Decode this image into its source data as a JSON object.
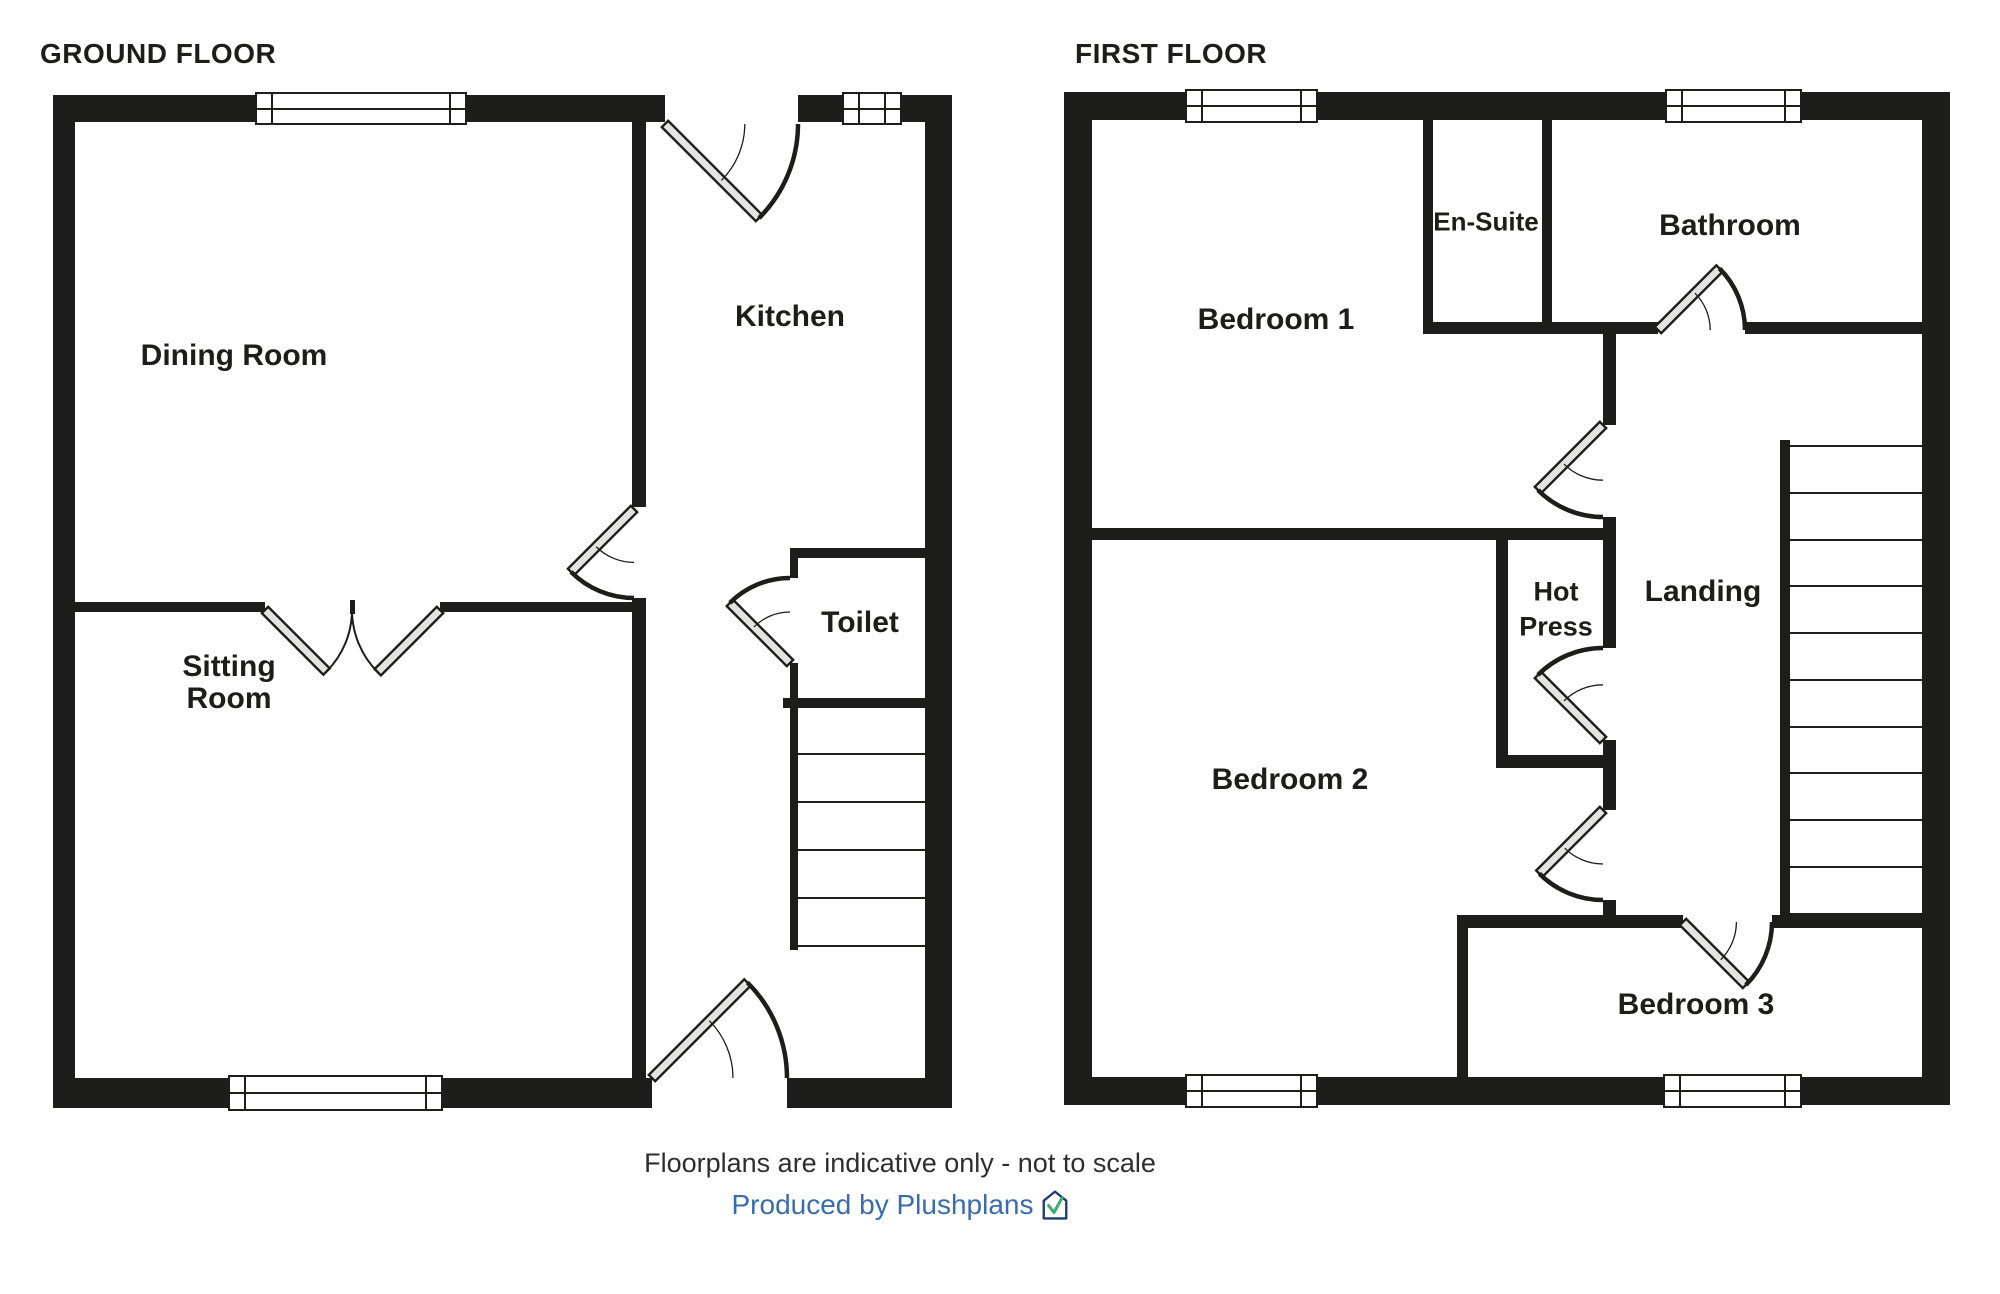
{
  "colors": {
    "wall": "#1d1d1b",
    "line": "#1d1d1b",
    "door_leaf_fill": "#e3e3e3",
    "footer_text": "#2e2e2e",
    "credit_blue": "#3a6cad",
    "logo_navy": "#1f3d73",
    "logo_green": "#3bad68"
  },
  "floors": [
    {
      "id": "ground-floor",
      "title": "GROUND FLOOR",
      "walls": [
        [
          53,
          95,
          612,
          27
        ],
        [
          798,
          95,
          154,
          27
        ],
        [
          53,
          95,
          22,
          1013
        ],
        [
          925,
          95,
          27,
          1013
        ],
        [
          53,
          1078,
          599,
          30
        ],
        [
          787,
          1078,
          165,
          30
        ],
        [
          632,
          122,
          14,
          385
        ],
        [
          632,
          598,
          14,
          480
        ],
        [
          75,
          602,
          190,
          10
        ],
        [
          440,
          602,
          192,
          10
        ],
        [
          350,
          600,
          5,
          14
        ],
        [
          790,
          548,
          135,
          10
        ],
        [
          790,
          558,
          8,
          20
        ],
        [
          790,
          663,
          8,
          45
        ],
        [
          783,
          698,
          142,
          10
        ],
        [
          790,
          708,
          8,
          242
        ]
      ],
      "windows": [
        [
          255,
          92,
          212,
          33
        ],
        [
          842,
          92,
          60,
          33
        ],
        [
          228,
          1075,
          215,
          36
        ]
      ],
      "stair_treads": {
        "x": 798,
        "w": 127,
        "ys": [
          753,
          801,
          849,
          897,
          945
        ]
      },
      "doors": [
        {
          "hinge": [
            665,
            124
          ],
          "len": 133,
          "leaf": 45,
          "jamb": 0,
          "style": "single"
        },
        {
          "hinge": [
            634,
            509
          ],
          "len": 89,
          "leaf": 135,
          "jamb": 90,
          "style": "single"
        },
        {
          "hinge": [
            265,
            610
          ],
          "len": 87,
          "leaf": 45,
          "jamb": 0,
          "style": "double"
        },
        {
          "hinge": [
            440,
            610
          ],
          "len": 88,
          "leaf": 135,
          "jamb": 180,
          "style": "double"
        },
        {
          "hinge": [
            790,
            663
          ],
          "len": 85,
          "leaf": 225,
          "jamb": 270,
          "style": "single"
        },
        {
          "hinge": [
            652,
            1078
          ],
          "len": 135,
          "leaf": -45,
          "jamb": 0,
          "style": "single"
        }
      ],
      "rooms": [
        {
          "label": "Dining Room",
          "x": 234,
          "y": 356,
          "size": 30
        },
        {
          "label": "Kitchen",
          "x": 790,
          "y": 317,
          "size": 30
        },
        {
          "label": "Toilet",
          "x": 860,
          "y": 623,
          "size": 30
        },
        {
          "label": "Sitting",
          "x": 229,
          "y": 667,
          "size": 30
        },
        {
          "label": "Room",
          "x": 229,
          "y": 699,
          "size": 30
        }
      ]
    },
    {
      "id": "first-floor",
      "title": "FIRST FLOOR",
      "walls": [
        [
          1064,
          92,
          886,
          28
        ],
        [
          1064,
          92,
          28,
          1013
        ],
        [
          1922,
          92,
          28,
          1013
        ],
        [
          1064,
          1077,
          886,
          28
        ],
        [
          1423,
          120,
          10,
          212
        ],
        [
          1542,
          120,
          10,
          204
        ],
        [
          1423,
          322,
          235,
          12
        ],
        [
          1745,
          322,
          177,
          12
        ],
        [
          1603,
          334,
          13,
          91
        ],
        [
          1603,
          517,
          13,
          131
        ],
        [
          1603,
          740,
          13,
          70
        ],
        [
          1603,
          900,
          13,
          28
        ],
        [
          1092,
          528,
          524,
          12
        ],
        [
          1496,
          540,
          12,
          228
        ],
        [
          1496,
          755,
          120,
          13
        ],
        [
          1457,
          915,
          226,
          13
        ],
        [
          1772,
          915,
          18,
          13
        ],
        [
          1775,
          915,
          147,
          13
        ],
        [
          1457,
          928,
          11,
          149
        ],
        [
          1780,
          440,
          10,
          475
        ]
      ],
      "windows": [
        [
          1185,
          89,
          133,
          34
        ],
        [
          1665,
          89,
          137,
          34
        ],
        [
          1185,
          1074,
          133,
          34
        ],
        [
          1663,
          1074,
          139,
          34
        ]
      ],
      "stair_treads": {
        "x": 1790,
        "w": 132,
        "ys": [
          445,
          492,
          539,
          585,
          632,
          679,
          726,
          772,
          819,
          866,
          913
        ]
      },
      "doors": [
        {
          "hinge": [
            1658,
            330
          ],
          "len": 87,
          "leaf": -45,
          "jamb": 0,
          "style": "single"
        },
        {
          "hinge": [
            1603,
            425
          ],
          "len": 92,
          "leaf": 135,
          "jamb": 90,
          "style": "single"
        },
        {
          "hinge": [
            1603,
            740
          ],
          "len": 92,
          "leaf": 225,
          "jamb": 270,
          "style": "single"
        },
        {
          "hinge": [
            1603,
            810
          ],
          "len": 90,
          "leaf": 135,
          "jamb": 90,
          "style": "single"
        },
        {
          "hinge": [
            1683,
            922
          ],
          "len": 89,
          "leaf": 45,
          "jamb": 0,
          "style": "single"
        }
      ],
      "rooms": [
        {
          "label": "Bedroom 1",
          "x": 1276,
          "y": 320,
          "size": 30
        },
        {
          "label": "En-Suite",
          "x": 1486,
          "y": 222,
          "size": 26
        },
        {
          "label": "Bathroom",
          "x": 1730,
          "y": 226,
          "size": 30
        },
        {
          "label": "Hot",
          "x": 1556,
          "y": 592,
          "size": 27
        },
        {
          "label": "Press",
          "x": 1556,
          "y": 627,
          "size": 27
        },
        {
          "label": "Landing",
          "x": 1703,
          "y": 592,
          "size": 30
        },
        {
          "label": "Bedroom 2",
          "x": 1290,
          "y": 780,
          "size": 30
        },
        {
          "label": "Bedroom 3",
          "x": 1696,
          "y": 1005,
          "size": 30
        }
      ]
    }
  ],
  "footer": {
    "disclaimer": "Floorplans are indicative only - not to scale",
    "credit": "Produced by Plushplans",
    "logo_icon": "plushplans-house-check-icon"
  }
}
